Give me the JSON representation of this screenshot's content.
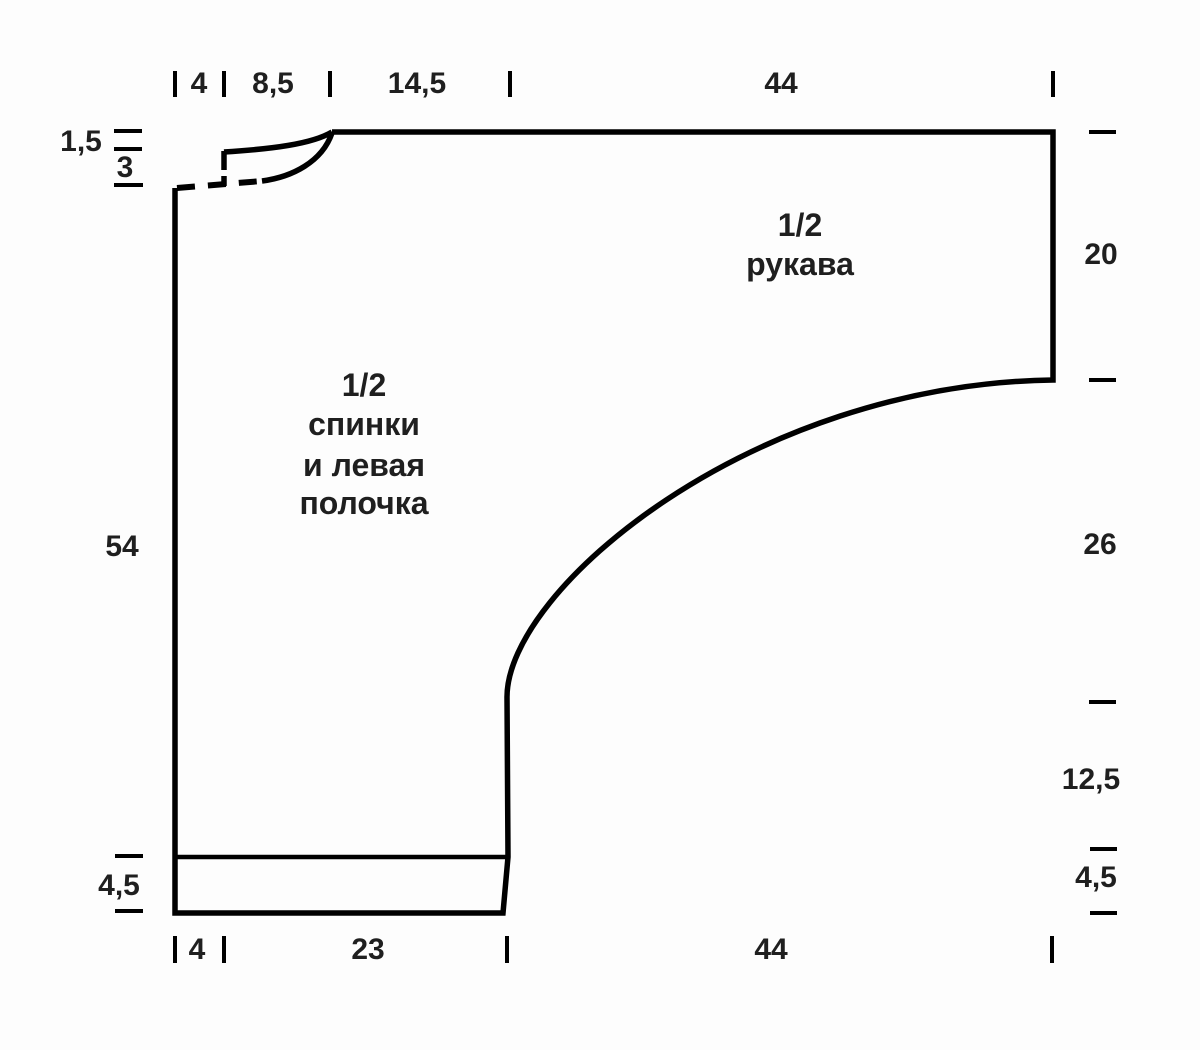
{
  "colors": {
    "line": "#000000",
    "text": "#1f1f1f",
    "background": "#fdfdfd"
  },
  "top_measurements": {
    "seg1": "4",
    "seg2": "8,5",
    "seg3": "14,5",
    "seg4": "44"
  },
  "bottom_measurements": {
    "seg1": "4",
    "seg2": "23",
    "seg3": "44"
  },
  "left_measurements": {
    "back_neck_depth": "1,5",
    "front_neck_depth": "3",
    "side_length": "54",
    "rib_height": "4,5"
  },
  "right_measurements": {
    "sleeve_edge": "20",
    "sleeve_slope": "26",
    "side": "12,5",
    "rib_height": "4,5"
  },
  "piece_labels": {
    "body": {
      "line1": "1/2",
      "line2": "спинки",
      "line3": "и левая",
      "line4": "полочка"
    },
    "sleeve": {
      "line1": "1/2",
      "line2": "рукава"
    }
  }
}
